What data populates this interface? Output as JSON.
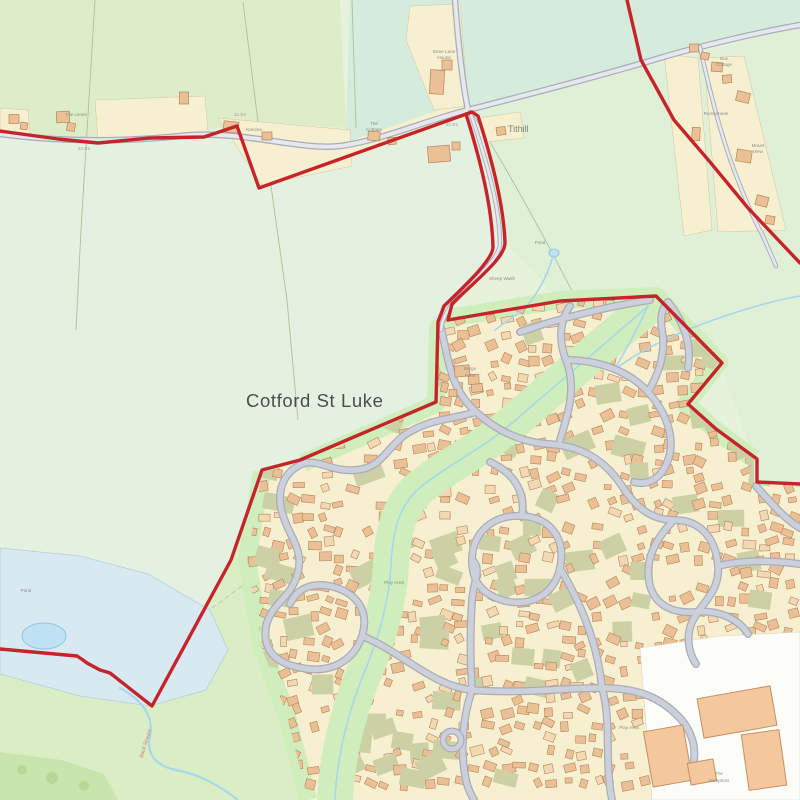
{
  "map": {
    "place": "Cotford St Luke",
    "hamlet": "Tithill",
    "labels": {
      "the_limes": "The Limes",
      "kamina": "Kamina",
      "the_cottage": [
        "The",
        "Cottage"
      ],
      "dene_lane_house": [
        "Dene Lane",
        "House"
      ],
      "runnymede": "Runnymede",
      "box_cottage": [
        "Box",
        "Cottage"
      ],
      "mount_view": [
        "Mount",
        "View"
      ],
      "barge_farm": [
        "Barge",
        "Farm"
      ],
      "sheep_wash": "Sheep Wash",
      "pond_small": "Pond",
      "pond_marsh": "Pond",
      "back_stream": "Back Stream",
      "play_area_west": "Play Area",
      "play_area_east": "Play Area",
      "the_hamptons": [
        "The",
        "Hamptons"
      ]
    },
    "spot_heights": [
      "42.1m",
      "42.3m",
      "42.4m"
    ],
    "colors": {
      "boundary": "#c5242b",
      "road_casing": "#a9adb9",
      "road_fill": "#ccd0da",
      "lane_fill": "#e6e8ee",
      "building": "#ecc096",
      "building_light": "#f3d8b4",
      "building_stroke": "#b4855a",
      "big_building": "#f4c89c",
      "big_building_stroke": "#c29166",
      "village_base": "#f6f0d0",
      "village_green": "#cfeebc",
      "garden_khaki": "#cbd1a4",
      "field_base": "#e6f2dc",
      "field_a": "#ddedca",
      "field_b": "#d5ebdc",
      "field_c": "#e4f1e0",
      "field_d": "#dff0d6",
      "field_e": "#daeec6",
      "marsh": "#d9e9f1",
      "pond": "#bfe2f2",
      "water": "#a7d7ec",
      "wood": "#c9e4ac",
      "hospital_white": "#fcfcf9",
      "label_gray": "#8a8f87",
      "title_gray": "#4d4d4d",
      "stream_label": "#cf7a76"
    }
  }
}
